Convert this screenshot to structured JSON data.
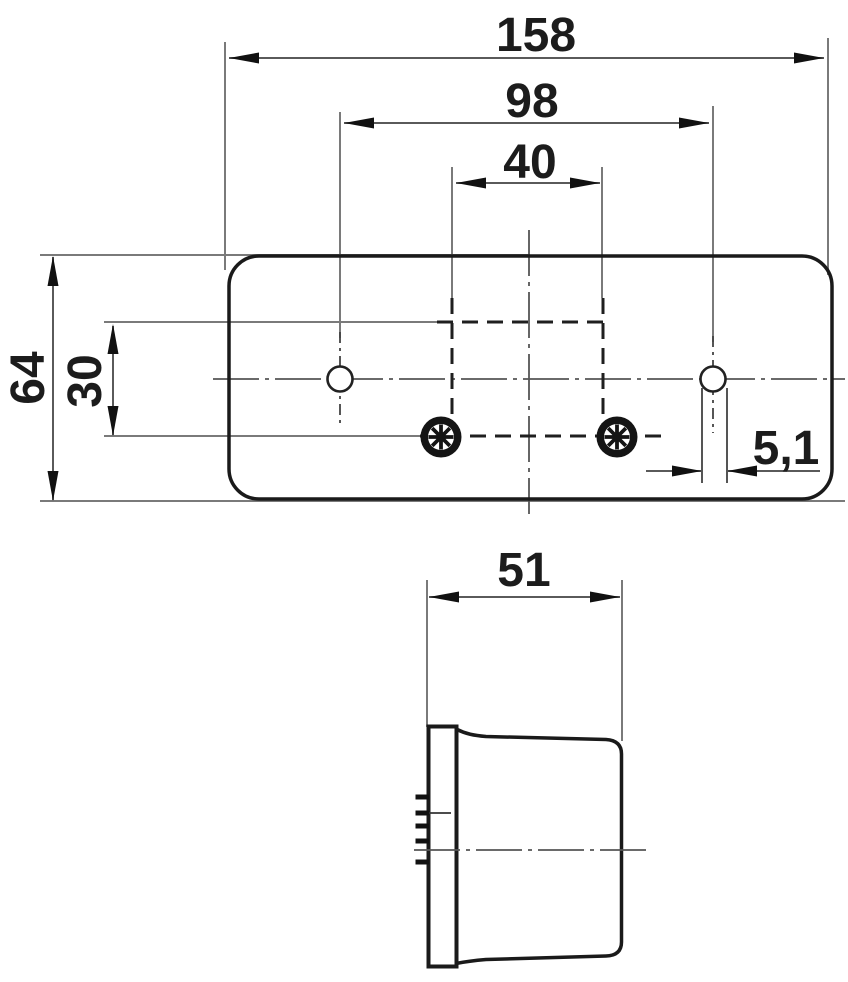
{
  "drawing": {
    "kind": "technical dimension drawing of a trailer tail lamp",
    "units": "mm",
    "views": {
      "front": {
        "name": "front-view",
        "dimensions": {
          "overall_width": "158",
          "hole_spacing": "98",
          "stud_spacing": "40",
          "overall_height": "64",
          "row_offset": "30",
          "hole_diameter": "5,1"
        }
      },
      "side": {
        "name": "side-view",
        "dimensions": {
          "depth": "51"
        }
      }
    },
    "colors": {
      "outline": "#1a1a1a",
      "thin_line": "#7a7a7a",
      "centerline": "#555555",
      "hidden_line": "#1f1f1f",
      "text": "#1c1c1c",
      "background": "#ffffff"
    }
  }
}
